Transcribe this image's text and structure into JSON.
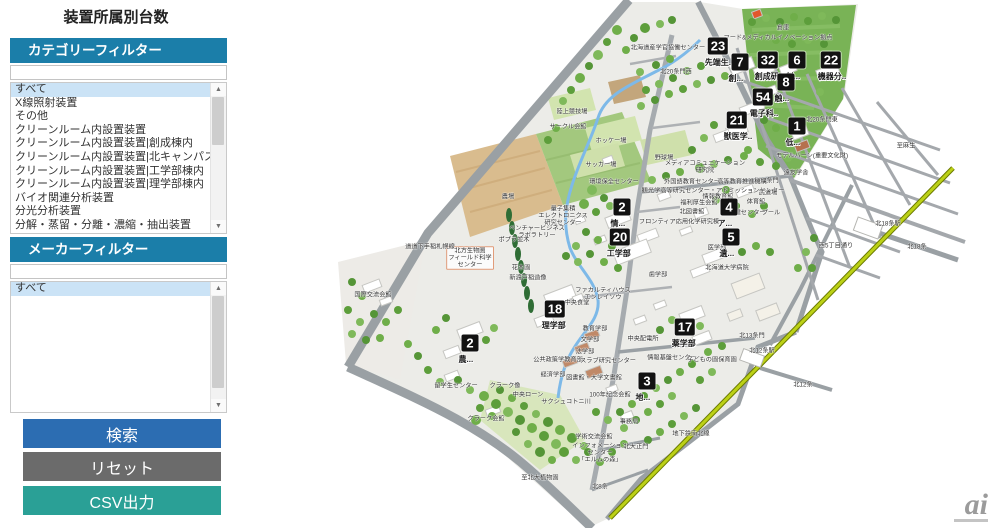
{
  "title": "装置所属別台数",
  "sidebar": {
    "category_filter": {
      "header": "カテゴリーフィルター",
      "input_value": "",
      "selected": "すべて",
      "options": [
        "すべて",
        "X線照射装置",
        "その他",
        "クリーンルーム内設置装置",
        "クリーンルーム内設置装置|創成棟内",
        "クリーンルーム内設置装置|北キャンパス総合研究棟2号館内",
        "クリーンルーム内設置装置|工学部棟内",
        "クリーンルーム内設置装置|理学部棟内",
        "バイオ関連分析装置",
        "分光分析装置",
        "分解・蒸留・分離・濃縮・抽出装置",
        "分離分析装置"
      ]
    },
    "maker_filter": {
      "header": "メーカーフィルター",
      "input_value": "",
      "selected": "すべて",
      "options": [
        "すべて"
      ]
    },
    "buttons": {
      "search": "検索",
      "reset": "リセット",
      "csv": "CSV出力"
    }
  },
  "map": {
    "colors": {
      "header_blue": "#1b7ea9",
      "search_blue": "#2c6db2",
      "reset_gray": "#6b6b6b",
      "csv_teal": "#2aa096",
      "campus_ground": "#ecece8",
      "field_green": "#79b356",
      "farm_tan": "#d9bc8e",
      "subway_line": "#bcd116",
      "road_gray": "#9aa0a4",
      "badge_black": "#121212",
      "river_blue": "#7db9e8"
    },
    "badges": [
      {
        "number": "23",
        "label": "先端生..",
        "x": 718,
        "y": 46
      },
      {
        "number": "7",
        "label": "創...",
        "x": 740,
        "y": 62
      },
      {
        "number": "32",
        "label": "創成研..",
        "x": 768,
        "y": 60
      },
      {
        "number": "6",
        "label": "創...",
        "x": 797,
        "y": 60
      },
      {
        "number": "22",
        "label": "機器分..",
        "x": 831,
        "y": 60
      },
      {
        "number": "8",
        "label": "触...",
        "x": 786,
        "y": 82
      },
      {
        "number": "54",
        "label": "電子科..",
        "x": 763,
        "y": 97
      },
      {
        "number": "21",
        "label": "獣医学..",
        "x": 737,
        "y": 120
      },
      {
        "number": "1",
        "label": "低...",
        "x": 797,
        "y": 126
      },
      {
        "number": "2",
        "label": "情...",
        "x": 622,
        "y": 207
      },
      {
        "number": "4",
        "label": "ア...",
        "x": 729,
        "y": 207
      },
      {
        "number": "20",
        "label": "工学部",
        "x": 620,
        "y": 237
      },
      {
        "number": "5",
        "label": "遺...",
        "x": 731,
        "y": 237
      },
      {
        "number": "18",
        "label": "理学部",
        "x": 555,
        "y": 309
      },
      {
        "number": "17",
        "label": "薬学部",
        "x": 685,
        "y": 327
      },
      {
        "number": "2",
        "label": "農...",
        "x": 470,
        "y": 343
      },
      {
        "number": "3",
        "label": "地...",
        "x": 647,
        "y": 381
      }
    ],
    "labels": [
      {
        "text": "倉庫",
        "x": 783,
        "y": 28
      },
      {
        "text": "フード&メディカルイノベーション拠点",
        "x": 778,
        "y": 38
      },
      {
        "text": "北海道産学官協働センター",
        "x": 668,
        "y": 48
      },
      {
        "text": "北20条門西",
        "x": 676,
        "y": 72
      },
      {
        "text": "北20条門東",
        "x": 822,
        "y": 120
      },
      {
        "text": "至麻生",
        "x": 906,
        "y": 146
      },
      {
        "text": "モデルバーン(重要文化財)",
        "x": 812,
        "y": 156
      },
      {
        "text": "遠友学舎",
        "x": 796,
        "y": 173
      },
      {
        "text": "北18条門",
        "x": 766,
        "y": 181
      },
      {
        "text": "北18条駅",
        "x": 888,
        "y": 224
      },
      {
        "text": "西5丁目通り",
        "x": 836,
        "y": 246
      },
      {
        "text": "北18条",
        "x": 917,
        "y": 247
      },
      {
        "text": "陸上競技場",
        "x": 572,
        "y": 112
      },
      {
        "text": "サークル会館",
        "x": 568,
        "y": 127
      },
      {
        "text": "ホッケー場",
        "x": 611,
        "y": 141
      },
      {
        "text": "サッカー場",
        "x": 601,
        "y": 165
      },
      {
        "text": "環境保全センター",
        "x": 614,
        "y": 182
      },
      {
        "text": "野球場",
        "x": 664,
        "y": 158
      },
      {
        "text": "メディアコミュニケーション\n研究院",
        "x": 705,
        "y": 167
      },
      {
        "text": "外国語教育センター",
        "x": 692,
        "y": 182
      },
      {
        "text": "高等教育推進機構",
        "x": 742,
        "y": 182
      },
      {
        "text": "観光学高等研究センター・アドミッションセンター",
        "x": 713,
        "y": 191
      },
      {
        "text": "福利厚生会館",
        "x": 699,
        "y": 203
      },
      {
        "text": "情報教育館",
        "x": 718,
        "y": 197
      },
      {
        "text": "北図書館",
        "x": 692,
        "y": 212
      },
      {
        "text": "武道場",
        "x": 768,
        "y": 193
      },
      {
        "text": "体育館",
        "x": 756,
        "y": 202
      },
      {
        "text": "保健センター",
        "x": 747,
        "y": 213
      },
      {
        "text": "プール",
        "x": 771,
        "y": 213
      },
      {
        "text": "農場",
        "x": 508,
        "y": 197
      },
      {
        "text": "ポプラ並木",
        "x": 514,
        "y": 240
      },
      {
        "text": "量子集積\nエレクトロニクス\n研究センター",
        "x": 563,
        "y": 216
      },
      {
        "text": "ベンチャービジネス\nラボラトリー",
        "x": 537,
        "y": 232
      },
      {
        "text": "北方生物圏\nフィールド科学\nセンター",
        "x": 470,
        "y": 258,
        "boxed": true
      },
      {
        "text": "花木園",
        "x": 521,
        "y": 268
      },
      {
        "text": "新渡戸稲造像",
        "x": 528,
        "y": 278
      },
      {
        "text": "道道下手稲札幌線",
        "x": 430,
        "y": 247
      },
      {
        "text": "フロンティア応用化学研究棟",
        "x": 679,
        "y": 222
      },
      {
        "text": "医学部",
        "x": 717,
        "y": 248
      },
      {
        "text": "北海道大学病院",
        "x": 727,
        "y": 268
      },
      {
        "text": "歯学部",
        "x": 658,
        "y": 275
      },
      {
        "text": "中央食堂",
        "x": 577,
        "y": 303
      },
      {
        "text": "ファカルティハウス\nエンレイソウ",
        "x": 603,
        "y": 294
      },
      {
        "text": "教育学部",
        "x": 595,
        "y": 329
      },
      {
        "text": "文学部",
        "x": 590,
        "y": 340
      },
      {
        "text": "法学部",
        "x": 585,
        "y": 352
      },
      {
        "text": "公共政策学教育部",
        "x": 558,
        "y": 360
      },
      {
        "text": "経済学部",
        "x": 553,
        "y": 375
      },
      {
        "text": "スラブ研究センター",
        "x": 608,
        "y": 361
      },
      {
        "text": "図書館・大学文書館",
        "x": 594,
        "y": 378
      },
      {
        "text": "100年記念会館",
        "x": 610,
        "y": 395
      },
      {
        "text": "クラーク像",
        "x": 505,
        "y": 386
      },
      {
        "text": "中央ローン",
        "x": 528,
        "y": 395
      },
      {
        "text": "サクシュコトニ川",
        "x": 566,
        "y": 402
      },
      {
        "text": "クラーク会館",
        "x": 486,
        "y": 419
      },
      {
        "text": "学術交流会館",
        "x": 594,
        "y": 437
      },
      {
        "text": "インフォメーション\nセンター\n「エルムの森」",
        "x": 600,
        "y": 453
      },
      {
        "text": "北大正門",
        "x": 636,
        "y": 447
      },
      {
        "text": "事務局",
        "x": 629,
        "y": 422
      },
      {
        "text": "至北大植物園",
        "x": 540,
        "y": 478
      },
      {
        "text": "北8条",
        "x": 600,
        "y": 487
      },
      {
        "text": "地下鉄南北線",
        "x": 691,
        "y": 434
      },
      {
        "text": "中央配電所",
        "x": 643,
        "y": 339
      },
      {
        "text": "情報基盤センター",
        "x": 672,
        "y": 358
      },
      {
        "text": "子どもの園保育園",
        "x": 712,
        "y": 360
      },
      {
        "text": "北13条門",
        "x": 752,
        "y": 336
      },
      {
        "text": "北12条駅",
        "x": 762,
        "y": 351
      },
      {
        "text": "北12条",
        "x": 803,
        "y": 385
      },
      {
        "text": "国際交流会館",
        "x": 373,
        "y": 295
      },
      {
        "text": "留学生センター",
        "x": 456,
        "y": 386
      }
    ]
  },
  "watermark": {
    "logo": "ai"
  }
}
